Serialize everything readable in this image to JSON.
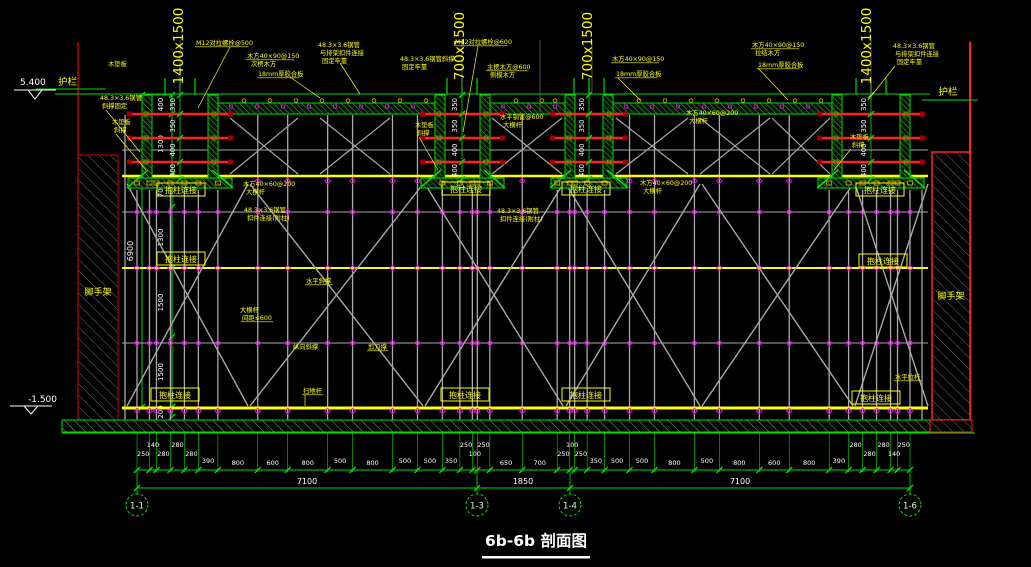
{
  "drawing_title": "6b-6b 剖面图",
  "elevation_top": "5.400",
  "elevation_bottom": "-1.500",
  "left_chain": {
    "overall": "6900",
    "segments": [
      "400",
      "1300",
      "700",
      "1300",
      "1500",
      "1500",
      "200"
    ]
  },
  "beam_dim_segments": [
    "350",
    "350",
    "400",
    "400"
  ],
  "beams": [
    {
      "size": "1400x1500"
    },
    {
      "size": "700x1500"
    },
    {
      "size": "700x1500"
    },
    {
      "size": "1400x1500"
    }
  ],
  "guardrail_left": "护栏",
  "guardrail_right": "护栏",
  "scaffold_left": "脚手架",
  "scaffold_right": "脚手架",
  "column_tie_label": "抱柱连接",
  "bottom_dims": {
    "values": [
      "250",
      "140",
      "280",
      "280",
      "280",
      "390",
      "800",
      "600",
      "800",
      "500",
      "800",
      "500",
      "500",
      "350",
      "250",
      "100",
      "250",
      "650",
      "700",
      "250",
      "100",
      "250",
      "350",
      "500",
      "500",
      "800",
      "500",
      "800",
      "600",
      "800",
      "390",
      "280",
      "280",
      "280",
      "140",
      "250"
    ],
    "totals": [
      "7100",
      "1850",
      "7100"
    ]
  },
  "grid_bubbles": [
    "1-1",
    "1-3",
    "1-4",
    "1-6"
  ],
  "annotations": [
    {
      "text": "木垫板",
      "x": 108,
      "y": 66
    },
    {
      "text": "M12对拉螺栓@500",
      "x": 196,
      "y": 45,
      "ul": true
    },
    {
      "text": "木方40×90@150",
      "x": 247,
      "y": 58,
      "ul": true
    },
    {
      "text": "次楞木方",
      "x": 251,
      "y": 66
    },
    {
      "text": "18mm厚胶合板",
      "x": 258,
      "y": 76,
      "ul": true
    },
    {
      "text": "48.3×3.6钢管",
      "x": 318,
      "y": 47
    },
    {
      "text": "与排架扣件连接",
      "x": 320,
      "y": 55
    },
    {
      "text": "固定牢靠",
      "x": 322,
      "y": 63
    },
    {
      "text": "48.3×3.6钢管",
      "x": 100,
      "y": 100
    },
    {
      "text": "斜撑固定",
      "x": 102,
      "y": 108
    },
    {
      "text": "木垫板",
      "x": 112,
      "y": 124
    },
    {
      "text": "斜撑",
      "x": 114,
      "y": 132
    },
    {
      "text": "48.3×3.6钢管斜撑",
      "x": 400,
      "y": 61
    },
    {
      "text": "固定牢靠",
      "x": 402,
      "y": 69
    },
    {
      "text": "M12对拉螺栓@600",
      "x": 455,
      "y": 44,
      "ul": true
    },
    {
      "text": "主楞木方@600",
      "x": 487,
      "y": 69,
      "ul": true
    },
    {
      "text": "侧模木方",
      "x": 490,
      "y": 77
    },
    {
      "text": "木垫板",
      "x": 415,
      "y": 127
    },
    {
      "text": "斜撑",
      "x": 417,
      "y": 135
    },
    {
      "text": "水平钢管@600",
      "x": 500,
      "y": 119
    },
    {
      "text": "大横杆",
      "x": 503,
      "y": 127
    },
    {
      "text": "木方40×90@150",
      "x": 612,
      "y": 61,
      "ul": true
    },
    {
      "text": "18mm厚胶合板",
      "x": 616,
      "y": 76,
      "ul": true
    },
    {
      "text": "木方40×90@150",
      "x": 752,
      "y": 47,
      "ul": true
    },
    {
      "text": "拉结木方",
      "x": 755,
      "y": 55
    },
    {
      "text": "18mm厚胶合板",
      "x": 758,
      "y": 67,
      "ul": true
    },
    {
      "text": "48.3×3.6钢管",
      "x": 893,
      "y": 48
    },
    {
      "text": "与排架扣件连接",
      "x": 895,
      "y": 56
    },
    {
      "text": "固定牢靠",
      "x": 897,
      "y": 64
    },
    {
      "text": "木垫板",
      "x": 850,
      "y": 139
    },
    {
      "text": "斜撑",
      "x": 852,
      "y": 147
    },
    {
      "text": "木方40×60@200",
      "x": 686,
      "y": 115
    },
    {
      "text": "大横杆",
      "x": 689,
      "y": 123
    },
    {
      "text": "木方40×60@200",
      "x": 243,
      "y": 186
    },
    {
      "text": "大横杆",
      "x": 246,
      "y": 194
    },
    {
      "text": "48.3×3.6钢管",
      "x": 244,
      "y": 212
    },
    {
      "text": "扣件连接(附柱)",
      "x": 247,
      "y": 220
    },
    {
      "text": "木方40×60@200",
      "x": 640,
      "y": 185
    },
    {
      "text": "大横杆",
      "x": 643,
      "y": 193
    },
    {
      "text": "48.3×3.6钢管",
      "x": 497,
      "y": 213
    },
    {
      "text": "扣件连接(附柱)",
      "x": 500,
      "y": 221
    },
    {
      "text": "水平斜撑",
      "x": 306,
      "y": 283,
      "ul": true
    },
    {
      "text": "大横杆",
      "x": 240,
      "y": 312
    },
    {
      "text": "间距≤600",
      "x": 242,
      "y": 320,
      "ul": true
    },
    {
      "text": "纵向斜撑",
      "x": 293,
      "y": 349
    },
    {
      "text": "剪刀撑",
      "x": 368,
      "y": 349,
      "ul": true
    },
    {
      "text": "扫地杆",
      "x": 303,
      "y": 393,
      "ul": true
    },
    {
      "text": "水平拉杆",
      "x": 895,
      "y": 379,
      "ul": true
    }
  ],
  "boxed_label_positions": [
    [
      181,
      190
    ],
    [
      466,
      189
    ],
    [
      586,
      189
    ],
    [
      880,
      190
    ],
    [
      181,
      259
    ],
    [
      883,
      261
    ],
    [
      175,
      395
    ],
    [
      465,
      395
    ],
    [
      586,
      395
    ],
    [
      876,
      398
    ]
  ],
  "colors": {
    "green": "#00DC00",
    "yellow": "#FFFF00",
    "red": "#FF2020",
    "dark_red": "#A00000",
    "gray": "#A8A8A8",
    "magenta": "#FF00FF",
    "white": "#FFFFFF",
    "orange": "#C8A000",
    "bubble_text": "#CFFFCF"
  }
}
